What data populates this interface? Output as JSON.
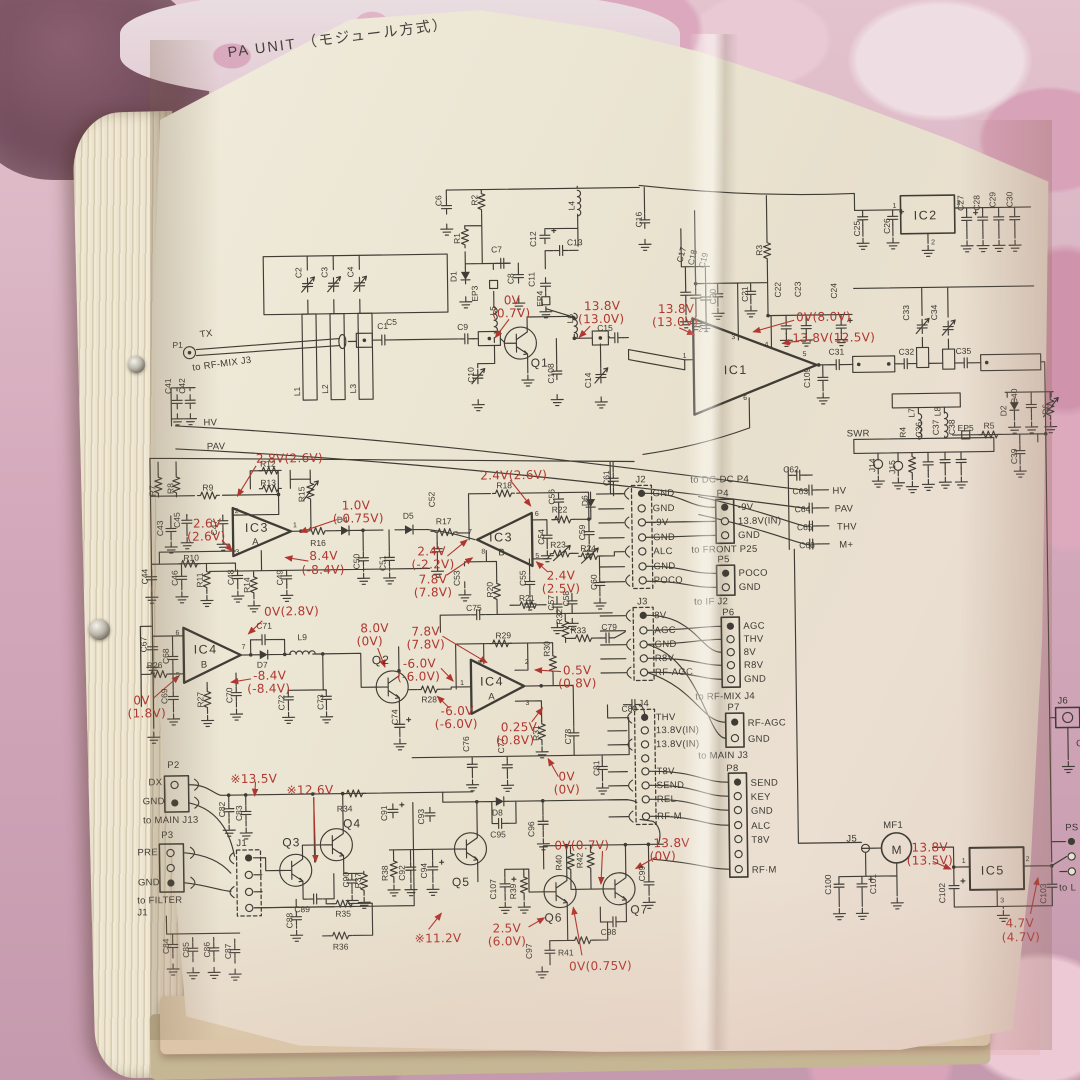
{
  "title": "PA UNIT （モジュール方式）",
  "net": {
    "hv": "HV",
    "pav": "PAV",
    "thv": "THV",
    "m": "M+",
    "swr": "SWR",
    "tx": "TX",
    "gnd": "GND"
  },
  "routes": {
    "rfmix_j3": "to RF-MIX J3",
    "dcdc": "to DC-DC P4",
    "front": "to FRONT P25",
    "ifj2": "to IF J2",
    "rfmix_j4": "to RF-MIX J4",
    "main_j3": "to MAIN J3",
    "main_j13": "to MAIN J13",
    "filter": "to FILTER",
    "filter_j1": "J1",
    "to_l": "to L"
  },
  "conn": {
    "j2": {
      "name": "J2",
      "pins": [
        "GND",
        "GND",
        "-9V",
        "GND",
        "ALC",
        "GND",
        "POCO"
      ]
    },
    "p4": {
      "name": "P4",
      "pins": [
        "-9V",
        "13.8V(IN)",
        "GND"
      ]
    },
    "p5": {
      "name": "P5",
      "pins": [
        "POCO",
        "GND"
      ]
    },
    "j3": {
      "name": "J3",
      "pins": [
        "8V",
        "AGC",
        "GND",
        "R8V",
        "RF-AGC"
      ]
    },
    "p6": {
      "name": "P6",
      "pins": [
        "AGC",
        "THV",
        "8V",
        "R8V",
        "GND"
      ]
    },
    "j4": {
      "name": "J4",
      "pins": [
        "THV",
        "13.8V(IN)",
        "13.8V(IN)",
        "T8V",
        "SEND",
        "REL",
        "RF·M"
      ]
    },
    "p7": {
      "name": "P7",
      "pins": [
        "RF-AGC",
        "GND"
      ]
    },
    "p8": {
      "name": "P8",
      "pins": [
        "SEND",
        "KEY",
        "GND",
        "ALC",
        "T8V",
        "RF·M"
      ]
    },
    "p2": {
      "name": "P2",
      "pins": [
        "DX",
        "GND"
      ]
    },
    "p3": {
      "name": "P3",
      "pins": [
        "PRE",
        "GND"
      ]
    },
    "j1": {
      "name": "J1"
    },
    "j5": {
      "name": "J5"
    },
    "j6": {
      "name": "J6",
      "pin": "GND"
    },
    "ps": {
      "name": "PS"
    }
  },
  "semi": {
    "q1": "Q1",
    "q2": "Q2",
    "q3": "Q3",
    "q4": "Q4",
    "q5": "Q5",
    "q6": "Q6",
    "q7": "Q7",
    "ic1": "IC1",
    "ic2": "IC2",
    "ic3": "IC3",
    "ic4": "IC4",
    "ic5": "IC5",
    "a": "A",
    "b": "B",
    "mf1": "MF1",
    "m": "M"
  },
  "pins": {
    "n1": "1",
    "n2": "2",
    "n3": "3",
    "n4": "4",
    "n5": "5",
    "n6": "6",
    "n7": "7",
    "n8": "8"
  },
  "refs": {
    "p1": "P1",
    "c1": "C1",
    "c2": "C2",
    "c3": "C3",
    "c4": "C4",
    "c5": "C5",
    "l1": "L1",
    "l2": "L2",
    "l3": "L3",
    "c41": "C41",
    "c42": "C42",
    "c6": "C6",
    "r1": "R1",
    "r2": "R2",
    "c7": "C7",
    "c8": "C8",
    "d1": "D1",
    "ep3": "EP3",
    "l5": "L5",
    "c9": "C9",
    "c10": "C10",
    "c11": "C11",
    "c12": "C12",
    "c13": "C13",
    "ep4": "EP4",
    "l6": "L6",
    "l4": "L4",
    "c14": "C14",
    "c15": "C15",
    "c16": "C16",
    "c108": "C108",
    "c17": "C17",
    "c18": "C18",
    "c19": "C19",
    "r3": "R3",
    "c20": "C20",
    "c21": "C21",
    "c22": "C22",
    "c23": "C23",
    "c24": "C24",
    "c25": "C25",
    "c26": "C26",
    "c27": "C27",
    "c28": "C28",
    "c29": "C29",
    "c30": "C30",
    "c31": "C31",
    "c32": "C32",
    "c33": "C33",
    "c34": "C34",
    "c35": "C35",
    "c109": "C109",
    "l7": "L7",
    "l8": "L8",
    "r4": "R4",
    "c36": "C36",
    "c37": "C37",
    "c38": "C38",
    "ep5": "EP5",
    "r5": "R5",
    "c39": "C39",
    "c40": "C40",
    "d2": "D2",
    "r6": "R6",
    "j14": "J14",
    "j15": "J15",
    "c62": "C62",
    "c63": "C63",
    "c64": "C64",
    "c65": "C65",
    "c66": "C66",
    "r7": "R7",
    "r8": "R8",
    "r9": "R9",
    "r10": "R10",
    "r11": "R11",
    "r12": "R12",
    "r13": "R13",
    "r14": "R14",
    "r15": "R15",
    "r16": "R16",
    "c43": "C43",
    "c44": "C44",
    "c45": "C45",
    "c46": "C46",
    "c47": "C47",
    "c48": "C48",
    "c49": "C49",
    "c50": "C50",
    "c51": "C51",
    "d4": "D4",
    "d5": "D5",
    "c52": "C52",
    "c53": "C53",
    "c54": "C54",
    "c55": "C55",
    "c56": "C56",
    "c57": "C57",
    "c58": "C58",
    "c59": "C59",
    "c60": "C60",
    "c61": "C61",
    "r17": "R17",
    "r18": "R18",
    "r20": "R20",
    "r21": "R21",
    "r22": "R22",
    "r23": "R23",
    "r24": "R24",
    "c75": "C75",
    "d6": "D6",
    "c67": "C67",
    "c68": "C68",
    "c69": "C69",
    "c70": "C70",
    "c71": "C71",
    "c72": "C72",
    "c73": "C73",
    "r26": "R26",
    "r27": "R27",
    "d7": "D7",
    "l9": "L9",
    "r28": "R28",
    "r29": "R29",
    "r30": "R30",
    "r31": "R31",
    "r32": "R32",
    "r33": "R33",
    "c74": "C74",
    "c76": "C76",
    "c77": "C77",
    "c78": "C78",
    "c79": "C79",
    "c80": "C80",
    "c81": "C81",
    "c82": "C82",
    "c83": "C83",
    "c84": "C84",
    "c85": "C85",
    "c86": "C86",
    "c87": "C87",
    "c88": "C88",
    "c89": "C89",
    "c90": "C90",
    "r34": "R34",
    "r35": "R35",
    "r36": "R36",
    "r37": "R37",
    "c91": "C91",
    "c92": "C92",
    "c93": "C93",
    "c94": "C94",
    "c95": "C95",
    "c96": "C96",
    "d8": "D8",
    "r38": "R38",
    "c107": "C107",
    "r39": "R39",
    "r40": "R40",
    "r41": "R41",
    "r42": "R42",
    "c97": "C97",
    "c98": "C98",
    "c99": "C99",
    "c100": "C100",
    "c101": "C101",
    "c102": "C102",
    "c103": "C103"
  },
  "volts": [
    {
      "a": "0V",
      "b": "(0.7V)"
    },
    {
      "a": "13.8V",
      "b": "(13.0V)"
    },
    {
      "a": "13.8V",
      "b": "(13.0V)"
    },
    {
      "a": "0V(8.0V)"
    },
    {
      "a": "13.8V(12.5V)"
    },
    {
      "a": "2.8V(2.6V)"
    },
    {
      "a": "2.6V",
      "b": "(2.6V)"
    },
    {
      "a": "1.0V",
      "b": "(-0.75V)"
    },
    {
      "a": "8.4V",
      "b": "(-8.4V)"
    },
    {
      "a": "0V(2.8V)"
    },
    {
      "a": "2.4V(2.6V)"
    },
    {
      "a": "2.4V",
      "b": "(-2.2V)"
    },
    {
      "a": "7.8V",
      "b": "(7.8V)"
    },
    {
      "a": "2.4V",
      "b": "(2.5V)"
    },
    {
      "a": "8.0V",
      "b": "(0V)"
    },
    {
      "a": "7.8V",
      "b": "(7.8V)"
    },
    {
      "a": "-6.0V",
      "b": "(-6.0V)"
    },
    {
      "a": "-6.0V",
      "b": "(-6.0V)"
    },
    {
      "a": "0.5V",
      "b": "(0.8V)"
    },
    {
      "a": "0.25V",
      "b": "(0.8V)"
    },
    {
      "a": "0V",
      "b": "(0V)"
    },
    {
      "a": "0V",
      "b": "(1.8V)"
    },
    {
      "a": "-8.4V",
      "b": "(-8.4V)"
    },
    {
      "a": "※13.5V"
    },
    {
      "a": "※12.6V"
    },
    {
      "a": "※11.2V"
    },
    {
      "a": "2.5V",
      "b": "(6.0V)"
    },
    {
      "a": "0V(0.7V)"
    },
    {
      "a": "0V(0.75V)"
    },
    {
      "a": "13.8V",
      "b": "(0V)"
    },
    {
      "a": "13.8V",
      "b": "(13.5V)"
    },
    {
      "a": "4.7V",
      "b": "(4.7V)"
    }
  ]
}
